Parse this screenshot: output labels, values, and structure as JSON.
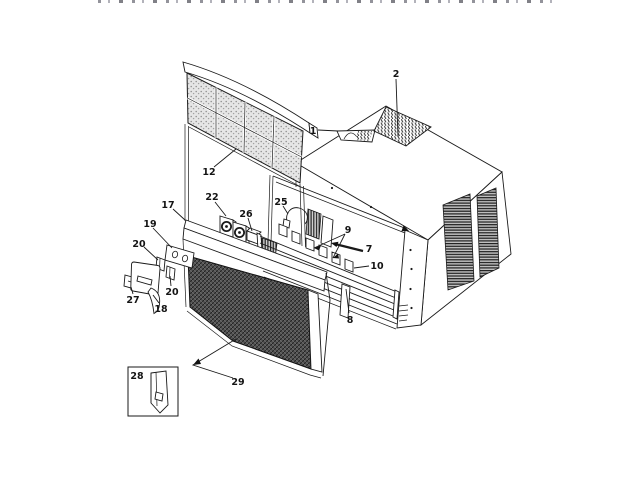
{
  "figure": {
    "type": "exploded-parts-diagram",
    "subject": "room air conditioner cabinet, filter grille and front panel assembly",
    "top_strip": "cropped illegible text row at top edge of scan",
    "labels": {
      "p1": "1",
      "p2": "2",
      "p7": "7",
      "p8": "8",
      "p9": "9",
      "p10": "10",
      "p12": "12",
      "p17": "17",
      "p18": "18",
      "p19": "19",
      "p20a": "20",
      "p20b": "20",
      "p22": "22",
      "p25": "25",
      "p26": "26",
      "p27": "27",
      "p28": "28",
      "p29": "29"
    },
    "colors": {
      "line": "#1a1a1a",
      "background": "#ffffff",
      "filter_stipple": "#e6e6e6",
      "grille_dark": "#4e4e4e",
      "vent_dark": "#1f1f1f"
    }
  }
}
